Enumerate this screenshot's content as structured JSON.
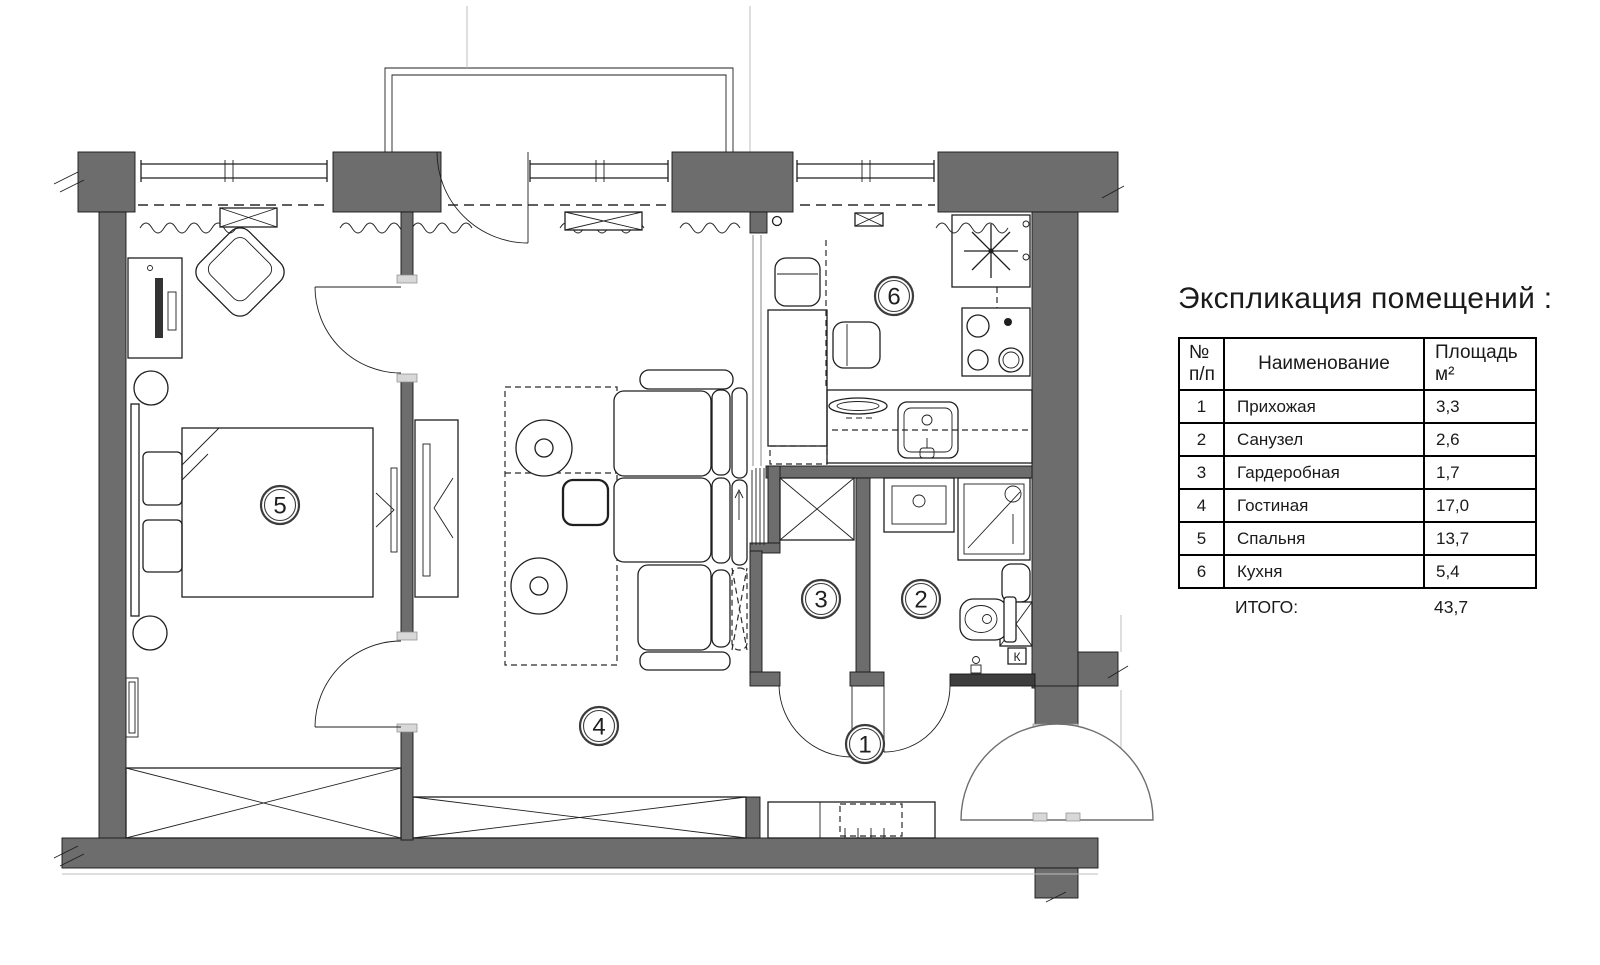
{
  "colors": {
    "wall_gray": "#6d6d6d",
    "wall_dark": "#3d3d3d",
    "line": "#1f1f1f"
  },
  "plan": {
    "rooms": [
      {
        "number": "1"
      },
      {
        "number": "2"
      },
      {
        "number": "3"
      },
      {
        "number": "4"
      },
      {
        "number": "5"
      },
      {
        "number": "6"
      }
    ],
    "k_label": "К"
  },
  "legend": {
    "title": "Экспликация помещений :",
    "table": {
      "header": {
        "num_top": "№",
        "num_bottom": "п/п",
        "name": "Наименование",
        "area": "Площадь м²"
      },
      "rows": [
        {
          "num": "1",
          "name": "Прихожая",
          "area": "3,3"
        },
        {
          "num": "2",
          "name": "Санузел",
          "area": "2,6"
        },
        {
          "num": "3",
          "name": "Гардеробная",
          "area": "1,7"
        },
        {
          "num": "4",
          "name": "Гостиная",
          "area": "17,0"
        },
        {
          "num": "5",
          "name": "Спальня",
          "area": "13,7"
        },
        {
          "num": "6",
          "name": "Кухня",
          "area": "5,4"
        }
      ],
      "total_label": "ИТОГО:",
      "total_value": "43,7"
    }
  }
}
